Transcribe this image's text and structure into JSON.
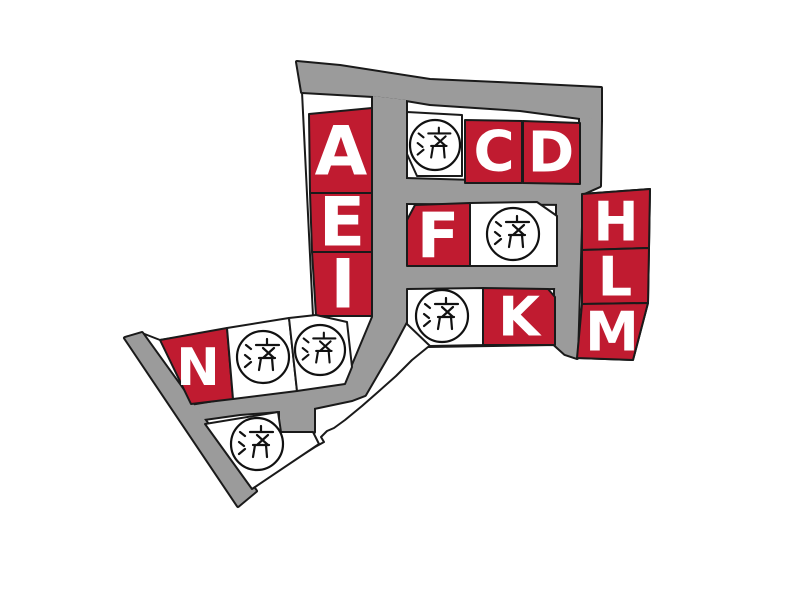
{
  "map": {
    "sold_badge_label": "済",
    "colors": {
      "available_lot": "#c01b30",
      "sold_lot": "#ffffff",
      "road": "#9b9b9b",
      "outline": "#1a1a1a",
      "lot_letter": "#ffffff",
      "badge_ink": "#111111",
      "background": "#ffffff"
    },
    "lots": [
      {
        "id": "A",
        "label": "A",
        "status": "available"
      },
      {
        "id": "C",
        "label": "C",
        "status": "available"
      },
      {
        "id": "D",
        "label": "D",
        "status": "available"
      },
      {
        "id": "E",
        "label": "E",
        "status": "available"
      },
      {
        "id": "F",
        "label": "F",
        "status": "available"
      },
      {
        "id": "H",
        "label": "H",
        "status": "available"
      },
      {
        "id": "I",
        "label": "I",
        "status": "available"
      },
      {
        "id": "K",
        "label": "K",
        "status": "available"
      },
      {
        "id": "L",
        "label": "L",
        "status": "available"
      },
      {
        "id": "M",
        "label": "M",
        "status": "available"
      },
      {
        "id": "N",
        "label": "N",
        "status": "available"
      },
      {
        "id": "S1",
        "label": "済",
        "status": "sold"
      },
      {
        "id": "S2",
        "label": "済",
        "status": "sold"
      },
      {
        "id": "S3",
        "label": "済",
        "status": "sold"
      },
      {
        "id": "S4",
        "label": "済",
        "status": "sold"
      },
      {
        "id": "S5",
        "label": "済",
        "status": "sold"
      },
      {
        "id": "S6",
        "label": "済",
        "status": "sold"
      }
    ]
  }
}
